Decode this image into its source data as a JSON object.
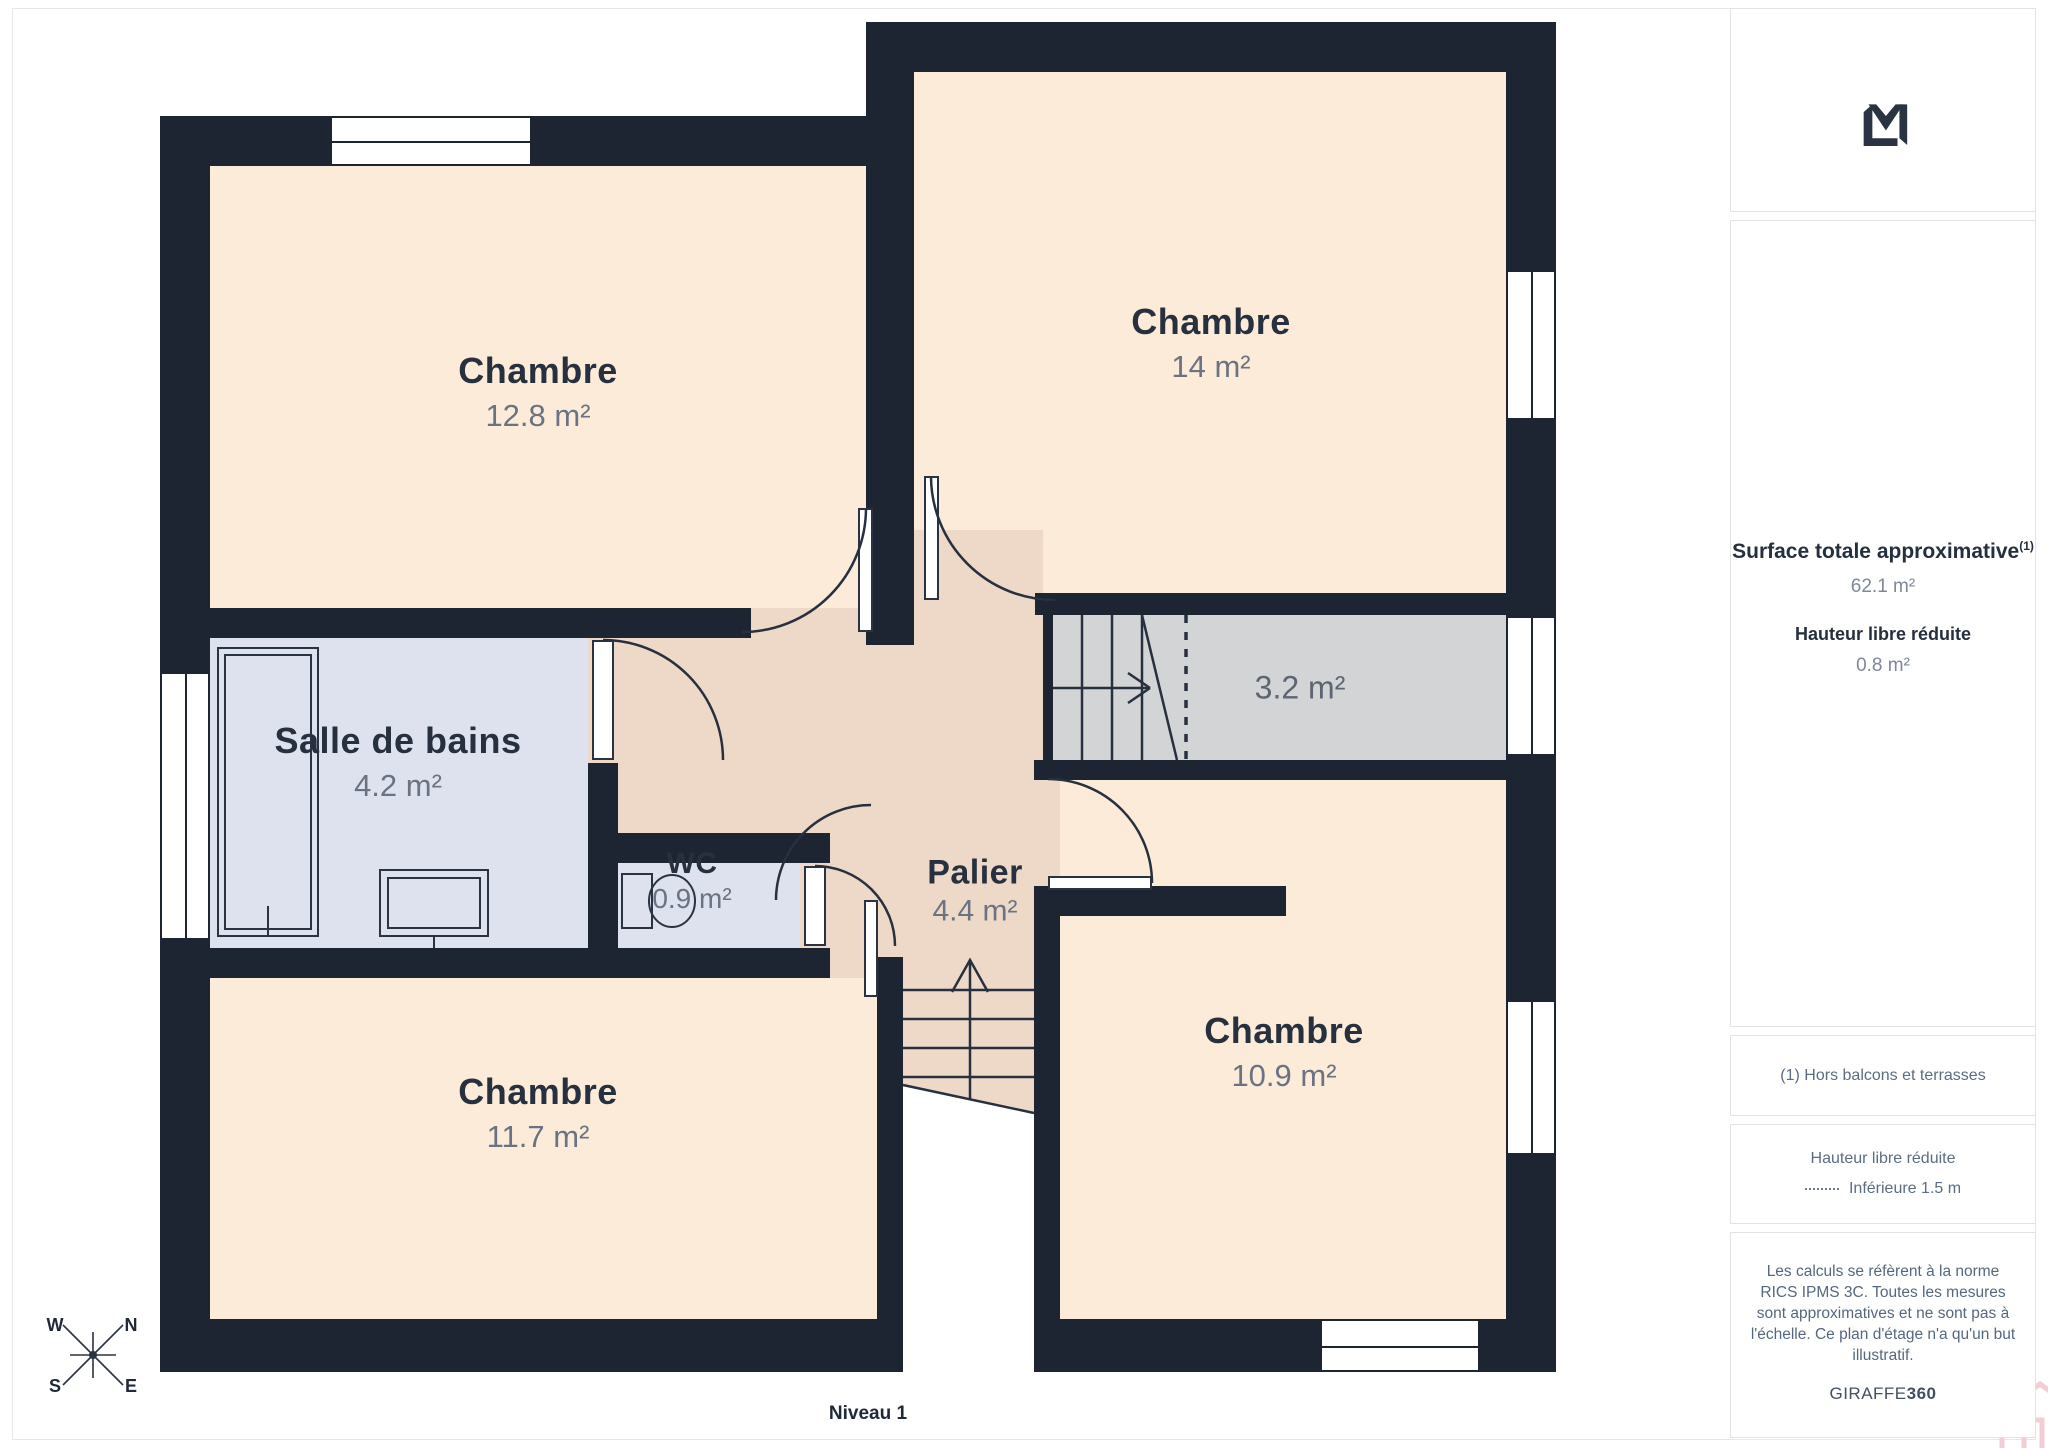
{
  "level_label": "Niveau 1",
  "rooms": [
    {
      "name": "Chambre",
      "area": "12.8 m²"
    },
    {
      "name": "Chambre",
      "area": "14 m²"
    },
    {
      "name": "Salle de bains",
      "area": "4.2 m²"
    },
    {
      "name": "WC",
      "area": "0.9 m²"
    },
    {
      "name": "Palier",
      "area": "4.4 m²"
    },
    {
      "name": "Chambre",
      "area": "11.7 m²"
    },
    {
      "name": "Chambre",
      "area": "10.9 m²"
    }
  ],
  "stairs_label": "3.2 m²",
  "compass": {
    "n": "N",
    "s": "S",
    "e": "E",
    "w": "W"
  },
  "sidebar": {
    "surface_title": "Surface totale approximative",
    "surface_sup": "(1)",
    "surface_value": "62.1 m²",
    "height_title": "Hauteur libre réduite",
    "height_value": "0.8 m²",
    "note1": "(1) Hors balcons et terrasses",
    "legend_title": "Hauteur libre réduite",
    "legend_item": "Inférieure 1.5 m",
    "disclaimer": "Les calculs se réfèrent à la norme RICS IPMS 3C. Toutes les mesures sont approximatives et ne sont pas à l'échelle. Ce plan d'étage n'a qu'un but illustratif.",
    "brand": "GIRAFFE",
    "brand_bold": "360"
  },
  "colors": {
    "wall": "#1D2532",
    "bedroom_fill": "#FCEBD9",
    "hall_fill": "#EED8C8",
    "wet_fill": "#DDE2EE",
    "stairs_fill": "#D3D4D6",
    "accent_pink": "#F3CDD4"
  }
}
